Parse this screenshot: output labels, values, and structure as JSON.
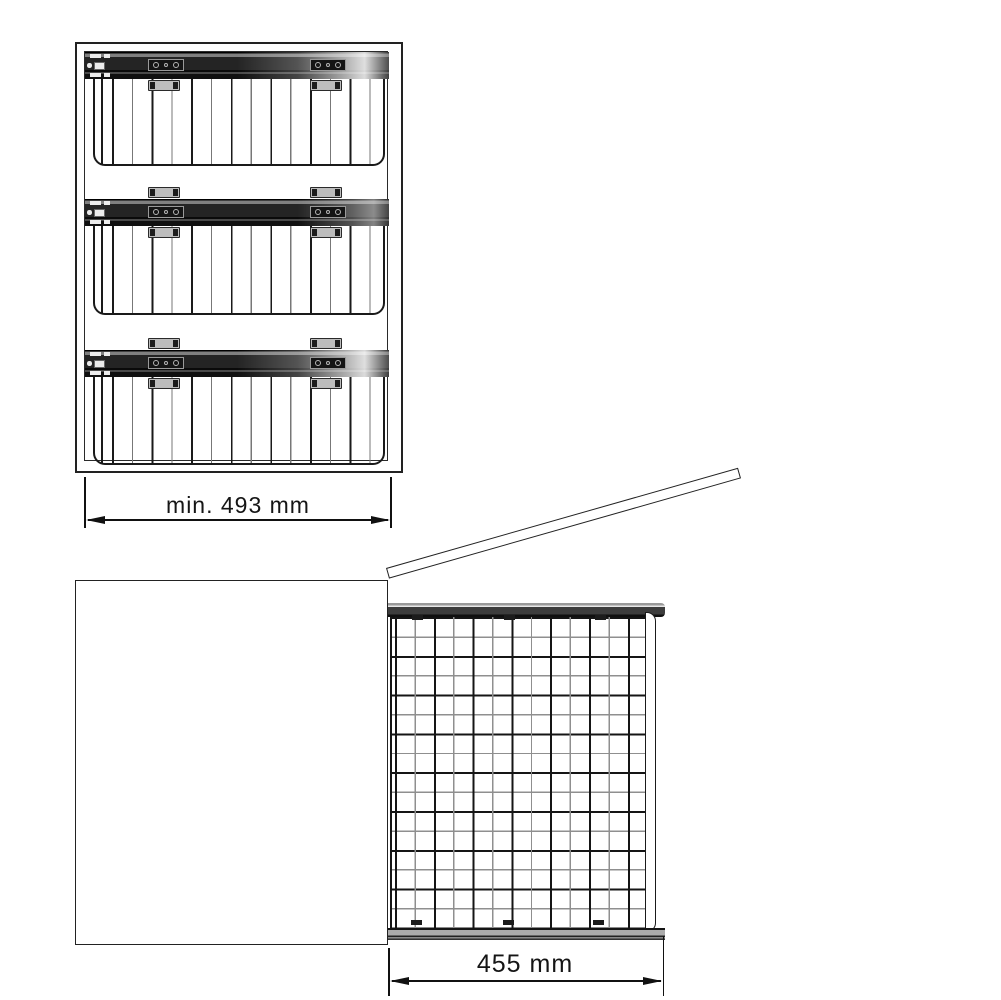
{
  "drawing": {
    "dimensions": {
      "cabinet_min_width": "min. 493 mm",
      "basket_width": "455 mm"
    },
    "front_view": {
      "basket_count": 3
    },
    "colors": {
      "line": "#1a1a1a",
      "rail_dark": "#1f1f1f",
      "rail_shine": "#d8d8d8",
      "bracket_gray": "#bdbdbd",
      "mesh_gray": "#8f8f8f",
      "background": "#ffffff"
    }
  }
}
